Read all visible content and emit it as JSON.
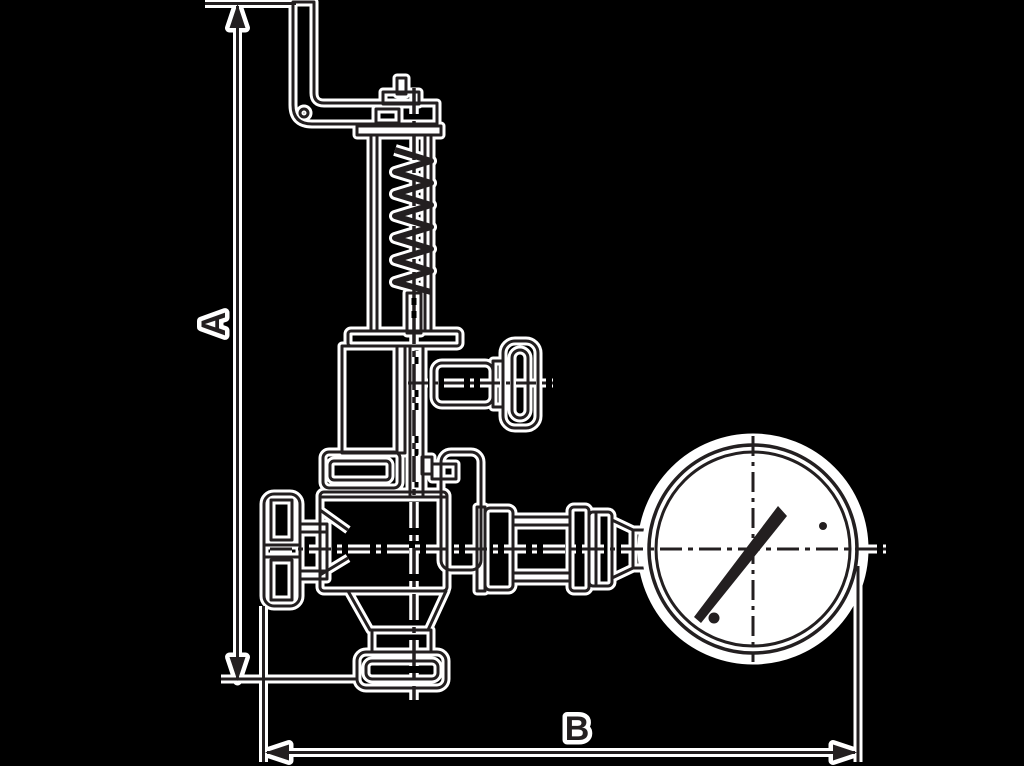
{
  "drawing": {
    "kind": "valve-with-pressure-gauge-dimension-drawing",
    "dimensions": {
      "vertical_label": "A",
      "horizontal_label": "B"
    }
  },
  "colors": {
    "background": "#000000",
    "ink": "#231f20",
    "halo": "#ffffff",
    "gauge_face": "#ffffff"
  }
}
